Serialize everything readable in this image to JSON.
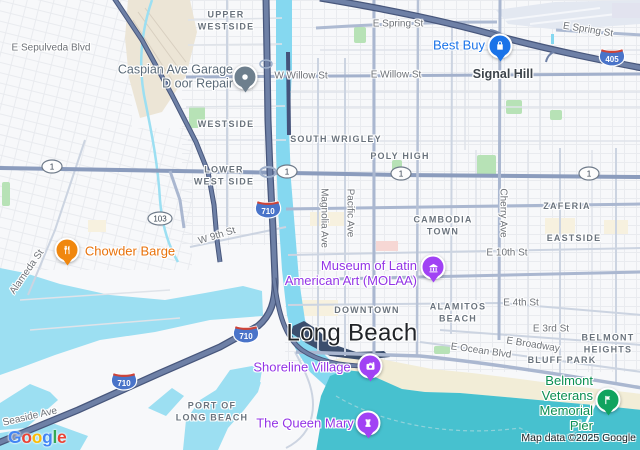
{
  "city": {
    "name": "Long Beach"
  },
  "town": {
    "name": "Signal Hill"
  },
  "nb": [
    {
      "t": "UPPER\nWESTSIDE"
    },
    {
      "t": "WESTSIDE"
    },
    {
      "t": "SOUTH WRIGLEY"
    },
    {
      "t": "LOWER\nWEST SIDE"
    },
    {
      "t": "POLY HIGH"
    },
    {
      "t": "CAMBODIA\nTOWN"
    },
    {
      "t": "ZAFERIA"
    },
    {
      "t": "EASTSIDE"
    },
    {
      "t": "DOWNTOWN"
    },
    {
      "t": "ALAMITOS\nBEACH"
    },
    {
      "t": "BELMONT\nHEIGHTS"
    },
    {
      "t": "BLUFF PARK"
    },
    {
      "t": "PORT OF\nLONG BEACH"
    }
  ],
  "st": [
    {
      "t": "E Sepulveda Blvd"
    },
    {
      "t": "W Willow St"
    },
    {
      "t": "E Willow St"
    },
    {
      "t": "E Spring St"
    },
    {
      "t": "E Spring St"
    },
    {
      "t": "W 9th St"
    },
    {
      "t": "E 10th St"
    },
    {
      "t": "E 4th St"
    },
    {
      "t": "E 3rd St"
    },
    {
      "t": "E Broadway"
    },
    {
      "t": "E Ocean Blvd"
    },
    {
      "t": "Alameda St"
    },
    {
      "t": "Seaside Ave"
    },
    {
      "t": "Magnolia Ave"
    },
    {
      "t": "Pacific Ave"
    },
    {
      "t": "Cherry Ave"
    }
  ],
  "poi": [
    {
      "t": "Caspian Ave Garage\nD oor Repair",
      "color": "#5b6b79",
      "icon": "generic-place-icon"
    },
    {
      "t": "Best Buy",
      "color": "#1a73e8",
      "icon": "shopping-icon"
    },
    {
      "t": "Chowder Barge",
      "color": "#e8710a",
      "icon": "restaurant-icon"
    },
    {
      "t": "Museum of Latin\nAmerican Art (MOLAA)",
      "color": "#9334e6",
      "icon": "museum-icon"
    },
    {
      "t": "Shoreline Village",
      "color": "#9334e6",
      "icon": "camera-icon"
    },
    {
      "t": "The Queen Mary",
      "color": "#9334e6",
      "icon": "castle-icon"
    },
    {
      "t": "Belmont Veterans\nMemorial Pier",
      "color": "#0c8f52",
      "icon": "flag-icon"
    }
  ],
  "shield": {
    "i710": "710",
    "i405": "405",
    "r1": "1",
    "r103": "103"
  },
  "logo": {
    "letters": [
      {
        "ch": "G",
        "color": "#4285F4"
      },
      {
        "ch": "o",
        "color": "#EA4335"
      },
      {
        "ch": "o",
        "color": "#FBBC05"
      },
      {
        "ch": "g",
        "color": "#4285F4"
      },
      {
        "ch": "l",
        "color": "#34A853"
      },
      {
        "ch": "e",
        "color": "#EA4335"
      }
    ]
  },
  "attribution": {
    "t": "Map data ©2025 Google"
  },
  "map_colors": {
    "land": "#f7f8fa",
    "water_harbor": "#9cdff2",
    "water_river": "#85d8f0",
    "water_ocean": "#47c1cf",
    "sand": "#f2edd7",
    "park": "#b7e2b6",
    "freeway": "#6e80a6",
    "freeway_casing": "#48577c",
    "airport": "#e3e8f1"
  }
}
